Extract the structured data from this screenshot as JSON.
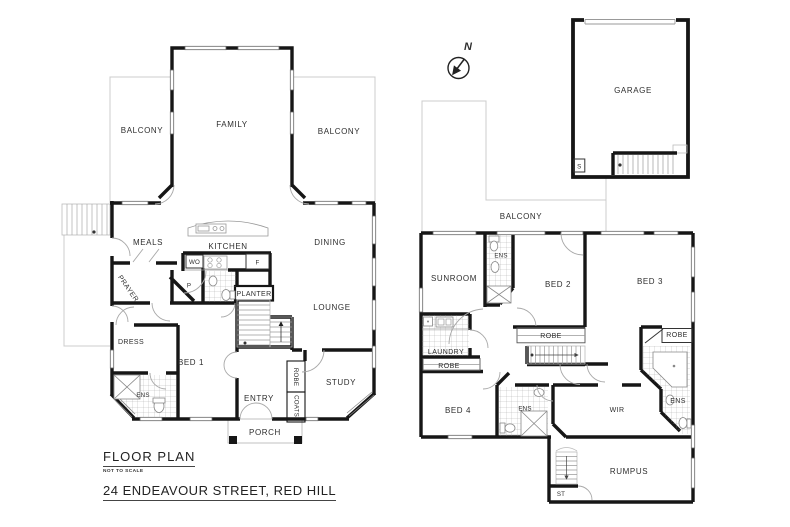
{
  "title_block": {
    "title": "FLOOR PLAN",
    "scale_note": "NOT TO SCALE",
    "address": "24 ENDEAVOUR STREET, RED HILL"
  },
  "compass": {
    "north_label": "N"
  },
  "colors": {
    "wall": "#161616",
    "outline": "#cccccc",
    "detail": "#8f8f8f",
    "text": "#2e2e2e"
  },
  "plan_left": {
    "balcony_left": "BALCONY",
    "family": "FAMILY",
    "balcony_right": "BALCONY",
    "meals": "MEALS",
    "kitchen": "KITCHEN",
    "dining": "DINING",
    "wall_oven": "WO",
    "fridge": "F",
    "pantry": "P",
    "prayer": "PRAYER",
    "planter": "PLANTER",
    "lounge": "LOUNGE",
    "dress": "DRESS",
    "bed1": "BED 1",
    "ens1": "ENS",
    "entry": "ENTRY",
    "robe_entry": "ROBE",
    "coats": "COATS",
    "study": "STUDY",
    "porch": "PORCH"
  },
  "plan_right": {
    "garage": "GARAGE",
    "store": "S",
    "balcony_rear": "BALCONY",
    "sunroom": "SUNROOM",
    "ens2": "ENS",
    "bed2": "BED 2",
    "bed3": "BED 3",
    "robe_bed2": "ROBE",
    "robe_bed3": "ROBE",
    "laundry": "LAUNDRY",
    "robe_bed4": "ROBE",
    "bed4": "BED 4",
    "ens4": "ENS",
    "wir": "WIR",
    "ens3": "ENS",
    "rumpus": "RUMPUS",
    "stair_store": "ST"
  }
}
